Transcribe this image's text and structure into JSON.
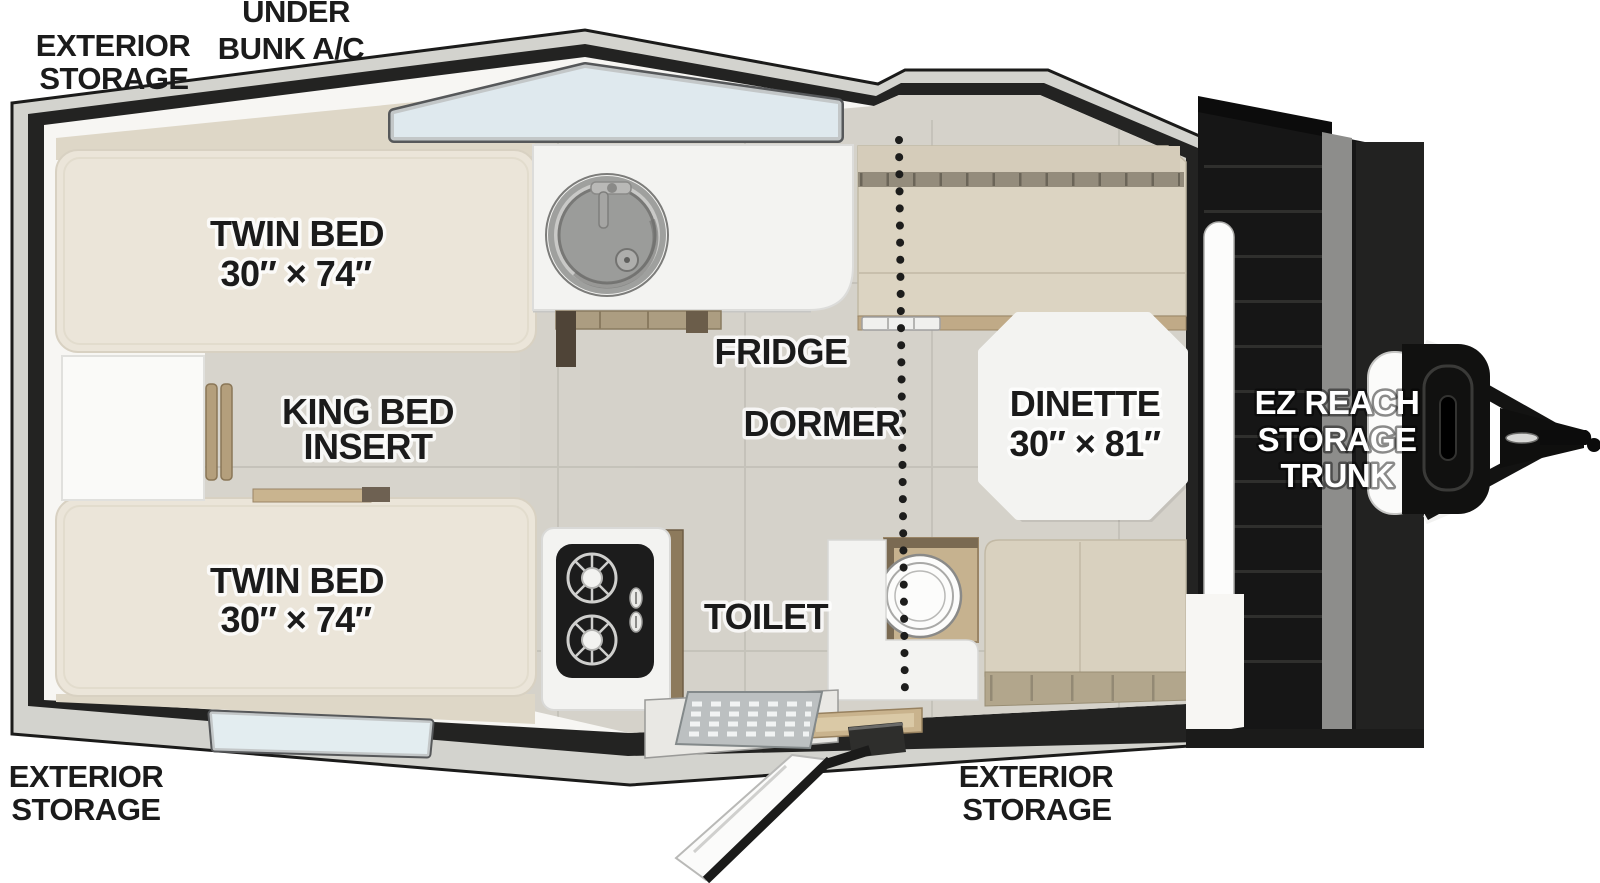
{
  "labels": {
    "exterior_storage_top": [
      "EXTERIOR",
      "STORAGE"
    ],
    "under_bunk_ac": [
      "UNDER",
      "BUNK A/C"
    ],
    "twin_bed_top": [
      "TWIN BED",
      "30″ × 74″"
    ],
    "king_bed_insert": [
      "KING BED",
      "INSERT"
    ],
    "twin_bed_bottom": [
      "TWIN BED",
      "30″ × 74″"
    ],
    "fridge": "FRIDGE",
    "dormer": "DORMER",
    "toilet": "TOILET",
    "dinette": [
      "DINETTE",
      "30″ × 81″"
    ],
    "ez_reach_storage_trunk": [
      "EZ REACH",
      "STORAGE",
      "TRUNK"
    ],
    "exterior_storage_bottom_left": [
      "EXTERIOR",
      "STORAGE"
    ],
    "exterior_storage_bottom_right": [
      "EXTERIOR",
      "STORAGE"
    ]
  },
  "colors": {
    "body_outline": "#1d1d1c",
    "roof_band": "#d3d3ce",
    "interior_wall": "#f7f6f3",
    "floor_tile": "#d5d2ca",
    "mattress": "#ebe5d9",
    "bench_cushion": "#d9d1bf",
    "bench_seat_edge": "#b2a68c",
    "wood_trim": "#c9b38d",
    "window_glass": "#dfe9ee",
    "counter_white": "#f3f3f1",
    "cooktop_black": "#1c1c1c",
    "trunk_black": "#161616",
    "label_text": "#1b1b1b",
    "label_text_light": "#ffffff"
  }
}
